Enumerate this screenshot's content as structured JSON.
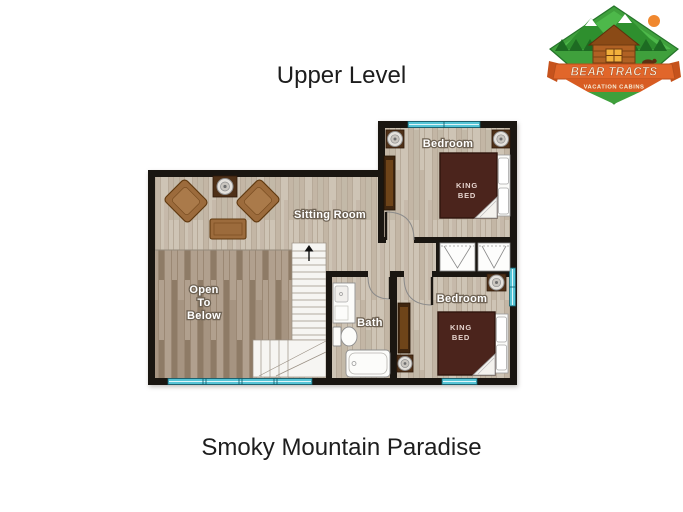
{
  "page": {
    "title": "Upper Level",
    "caption": "Smoky Mountain Paradise"
  },
  "logo": {
    "brand": "BEAR TRACTS",
    "tagline": "VACATION CABINS"
  },
  "floorplan": {
    "labels": {
      "sitting_room": "Sitting Room",
      "open_below": [
        "Open",
        "To",
        "Below"
      ],
      "bath": "Bath",
      "bedroom_upper": "Bedroom",
      "bedroom_lower": "Bedroom",
      "king_bed": [
        "KING",
        "BED"
      ]
    }
  },
  "colors": {
    "title_color": "#1d1d1d",
    "wall": "#1a1611",
    "window_fill": "#55c4d6",
    "window_stroke": "#17616f",
    "floor_base": "#cec4b5",
    "floor_stripe": "#b7aa99",
    "floor_plank": "#c3b6a5",
    "floor_dark_base": "#b1a08e",
    "floor_dark_stripe": "#9b8874",
    "floor_dark_plank": "#8e7b66",
    "bed_fill": "#4b241c",
    "bed_stroke": "#2f150d",
    "bed_text": "#e6d4ce",
    "furn_fill": "#9c6b3c",
    "furn_stroke": "#60390f",
    "furn_inner": "#aa7a4a",
    "dark_wood": "#4f3118",
    "dresser_fill": "#40260f",
    "dresser_inner": "#6e4419",
    "fixture_fill": "#fcfcfa",
    "fixture_stroke": "#8f8f8f",
    "stair_fill": "#f6f5f2",
    "stair_stroke": "#9a9084",
    "label_fill": "#ffffff",
    "label_outline": "#6f6354",
    "logo_green": "#3fa03c",
    "logo_green_dark": "#25742a",
    "logo_green_deep": "#1d6b22",
    "logo_orange": "#e1662a",
    "logo_orange_dark": "#c6521c",
    "logo_cream": "#f6eed9",
    "logo_brown": "#b06124",
    "logo_sun": "#f0882f"
  }
}
